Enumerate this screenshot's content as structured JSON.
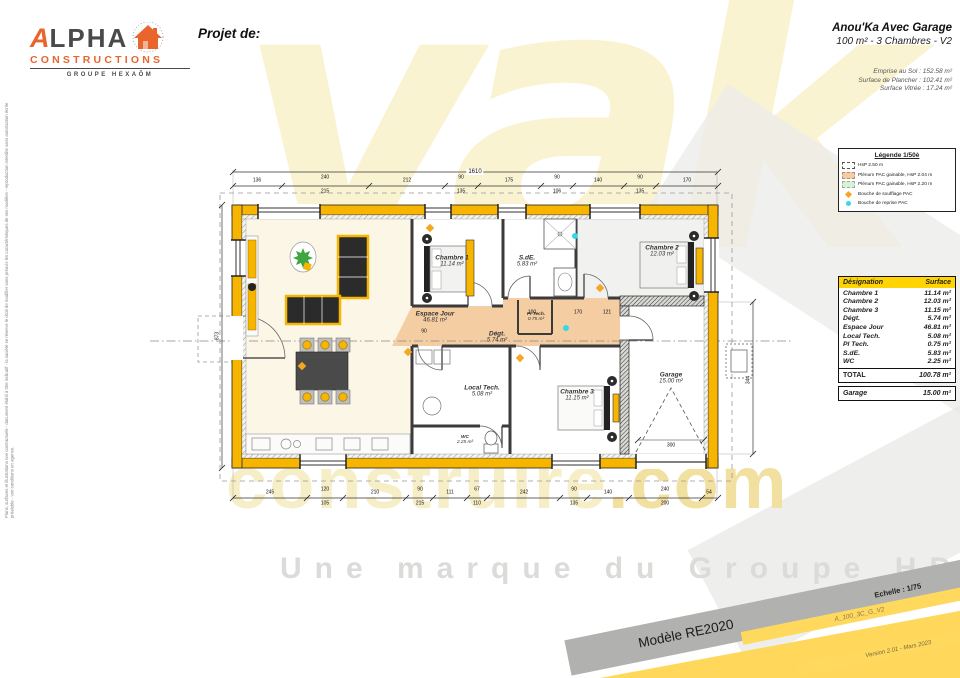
{
  "header": {
    "logo": {
      "brand_a": "A",
      "brand_rest": "LPHA",
      "line2": "CONSTRUCTIONS",
      "group": "GROUPE HEXAÔM"
    },
    "project_label": "Projet de:",
    "title": "Anou'Ka Avec Garage",
    "subtitle": "100 m² - 3 Chambres - V2",
    "stats": {
      "line1": "Emprise au Sol : 152.58 m²",
      "line2": "Surface de Plancher : 102.41 m²",
      "line3": "Surface Vitrée : 17.24 m²"
    }
  },
  "legend": {
    "title": "Légende 1/50è",
    "items": [
      {
        "label": "HsP 2.50 m"
      },
      {
        "label": "Plénum PAC gainable, HsP 2.04 m"
      },
      {
        "label": "Plénum PAC gainable, HsP 2.20 m"
      },
      {
        "label": "Bouche de soufflage PAC"
      },
      {
        "label": "Bouche de reprise PAC"
      }
    ]
  },
  "table": {
    "col_designation": "Désignation",
    "col_surface": "Surface",
    "rows": [
      {
        "name": "Chambre 1",
        "area": "11.14 m²"
      },
      {
        "name": "Chambre 2",
        "area": "12.03 m²"
      },
      {
        "name": "Chambre 3",
        "area": "11.15 m²"
      },
      {
        "name": "Dégt.",
        "area": "5.74 m²"
      },
      {
        "name": "Espace Jour",
        "area": "46.81 m²"
      },
      {
        "name": "Local Tech.",
        "area": "5.08 m²"
      },
      {
        "name": "Pl Tech.",
        "area": "0.75 m²"
      },
      {
        "name": "S.dE.",
        "area": "5.83 m²"
      },
      {
        "name": "WC",
        "area": "2.25 m²"
      }
    ],
    "total_label": "TOTAL",
    "total_value": "100.78 m²",
    "garage_label": "Garage",
    "garage_value": "15.00 m²"
  },
  "plan": {
    "rooms": [
      {
        "name": "Espace Jour",
        "area": "46.81 m²"
      },
      {
        "name": "Chambre 1",
        "area": "11.14 m²"
      },
      {
        "name": "S.dE.",
        "area": "5.83 m²"
      },
      {
        "name": "Chambre 2",
        "area": "12.03 m²"
      },
      {
        "name": "Dégt.",
        "area": "5.74 m²"
      },
      {
        "name": "Pl Tech.",
        "area": "0.75 m²"
      },
      {
        "name": "Local Tech.",
        "area": "5.08 m²"
      },
      {
        "name": "WC",
        "area": "2.25 m²"
      },
      {
        "name": "Chambre 3",
        "area": "11.15 m²"
      },
      {
        "name": "Garage",
        "area": "15.00 m²"
      }
    ],
    "dims": {
      "overall": "1610",
      "left_total": "873",
      "right_side": "344",
      "top": [
        "136",
        "240",
        "215",
        "212",
        "90",
        "135",
        "175",
        "90",
        "106",
        "140",
        "90",
        "135",
        "170"
      ],
      "bottom": [
        "245",
        "120",
        "105",
        "210",
        "90",
        "215",
        "111",
        "67",
        "110",
        "242",
        "90",
        "135",
        "140",
        "240",
        "200",
        "54"
      ],
      "inner": [
        "100",
        "170",
        "121",
        "300",
        "90"
      ]
    }
  },
  "banners": {
    "model": "Modèle RE2020",
    "scale": "Echelle : 1/75",
    "ref": "A_100_3C_G_V2",
    "version": "Version 2.01 - Mars 2023"
  },
  "watermark": {
    "big": "yak",
    "construire": "construire",
    "dotcom": ".com",
    "tagline": "Une marque du Groupe HDV"
  },
  "disclaimer": "Plans, surfaces et illustrations non contractuels - document établi à titre indicatif - la société se réserve le droit de modifier sans préavis les caractéristiques de ses modèles - reproduction interdite sans autorisation écrite préalable - voir conditions en agence."
}
